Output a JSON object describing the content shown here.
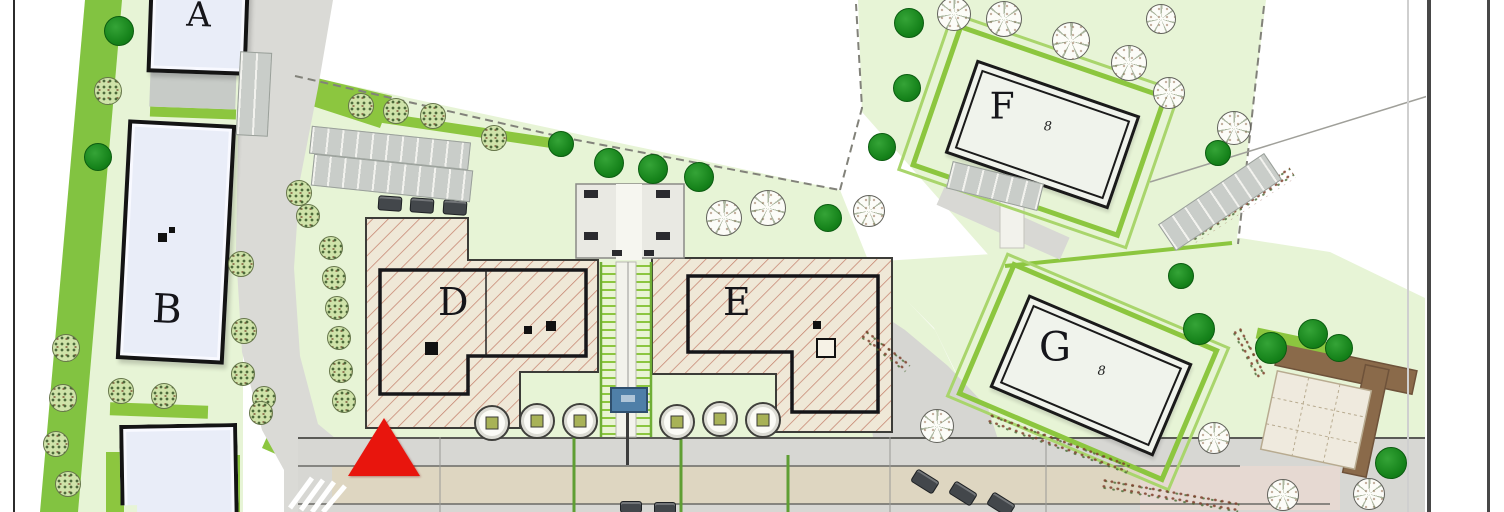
{
  "plan": {
    "labels": {
      "a": "A",
      "b": "B",
      "d": "D",
      "e": "E",
      "f": "F",
      "g": "G"
    },
    "entrance_marker": "8",
    "colors": {
      "lawn": "#e7f4d6",
      "grass_accent": "#8cc63f",
      "tree_dark": "#15821a",
      "road": "#d9d9d5",
      "paving_beige": "#ded6c1",
      "hatch_fill": "#efe8d7",
      "hatch_line": "#c5836e",
      "building_fill": "#e9edf8",
      "marker_red": "#e8150d",
      "sign_blue": "#4f7fa8",
      "path_brown": "#8a6a4a"
    },
    "features": {
      "trees_solid": [
        [
          118,
          30,
          14
        ],
        [
          97,
          156,
          13
        ],
        [
          560,
          143,
          12
        ],
        [
          608,
          162,
          14
        ],
        [
          652,
          168,
          14
        ],
        [
          698,
          176,
          14
        ],
        [
          827,
          217,
          13
        ],
        [
          881,
          146,
          13
        ],
        [
          908,
          22,
          14
        ],
        [
          906,
          87,
          13
        ],
        [
          1217,
          152,
          12
        ],
        [
          1180,
          275,
          12
        ],
        [
          1198,
          328,
          15
        ],
        [
          1270,
          347,
          15
        ],
        [
          1312,
          333,
          14
        ],
        [
          1338,
          347,
          13
        ],
        [
          1390,
          462,
          15
        ]
      ],
      "trees_outline": [
        [
          723,
          217,
          17
        ],
        [
          767,
          207,
          17
        ],
        [
          868,
          210,
          15
        ],
        [
          953,
          13,
          16
        ],
        [
          1003,
          18,
          17
        ],
        [
          1070,
          40,
          18
        ],
        [
          1128,
          62,
          17
        ],
        [
          1168,
          92,
          15
        ],
        [
          1233,
          127,
          16
        ],
        [
          1160,
          18,
          14
        ],
        [
          936,
          425,
          16
        ],
        [
          1213,
          437,
          15
        ],
        [
          1282,
          494,
          15
        ],
        [
          1368,
          493,
          15
        ]
      ],
      "trees_hatched": [
        [
          107,
          90,
          13
        ],
        [
          252,
          83,
          12
        ],
        [
          240,
          263,
          12
        ],
        [
          243,
          330,
          12
        ],
        [
          242,
          373,
          11
        ],
        [
          263,
          397,
          11
        ],
        [
          298,
          192,
          12
        ],
        [
          307,
          215,
          11
        ],
        [
          330,
          247,
          11
        ],
        [
          333,
          277,
          11
        ],
        [
          336,
          307,
          11
        ],
        [
          338,
          337,
          11
        ],
        [
          340,
          370,
          11
        ],
        [
          343,
          400,
          11
        ],
        [
          360,
          105,
          12
        ],
        [
          395,
          110,
          12
        ],
        [
          432,
          115,
          12
        ],
        [
          493,
          137,
          12
        ],
        [
          65,
          347,
          13
        ],
        [
          62,
          397,
          13
        ],
        [
          55,
          443,
          12
        ],
        [
          67,
          483,
          12
        ],
        [
          120,
          390,
          12
        ],
        [
          163,
          395,
          12
        ],
        [
          260,
          412,
          11
        ]
      ],
      "planters": [
        [
          490,
          421,
          16
        ],
        [
          535,
          419,
          16
        ],
        [
          578,
          419,
          16
        ],
        [
          675,
          420,
          16
        ],
        [
          718,
          417,
          16
        ],
        [
          761,
          418,
          16
        ]
      ],
      "cars": [
        [
          378,
          196,
          22,
          13,
          4
        ],
        [
          410,
          198,
          22,
          13,
          4
        ],
        [
          443,
          200,
          22,
          13,
          4
        ],
        [
          912,
          474,
          24,
          13,
          32
        ],
        [
          950,
          486,
          24,
          13,
          32
        ],
        [
          988,
          497,
          24,
          13,
          32
        ],
        [
          620,
          501,
          20,
          10,
          0
        ],
        [
          654,
          502,
          20,
          10,
          0
        ]
      ],
      "marks_filled": [
        [
          425,
          342,
          13
        ],
        [
          524,
          326,
          8
        ],
        [
          546,
          321,
          10
        ],
        [
          813,
          321,
          8
        ],
        [
          158,
          233,
          9
        ],
        [
          169,
          227,
          6
        ]
      ],
      "marks_outline": [
        [
          816,
          338,
          16
        ]
      ],
      "shrub_rows": [
        [
          983,
          437,
          150,
          13,
          20
        ],
        [
          1100,
          489,
          140,
          12,
          10
        ],
        [
          1222,
          346,
          54,
          12,
          62
        ],
        [
          856,
          344,
          58,
          13,
          38
        ],
        [
          1180,
          198,
          122,
          14,
          -33
        ]
      ],
      "stall_strips": [
        [
          310,
          134,
          158,
          26,
          6
        ],
        [
          312,
          162,
          158,
          30,
          6
        ],
        [
          948,
          172,
          92,
          26,
          14
        ],
        [
          1156,
          186,
          126,
          30,
          -34
        ],
        [
          238,
          52,
          30,
          82,
          3
        ]
      ]
    }
  }
}
